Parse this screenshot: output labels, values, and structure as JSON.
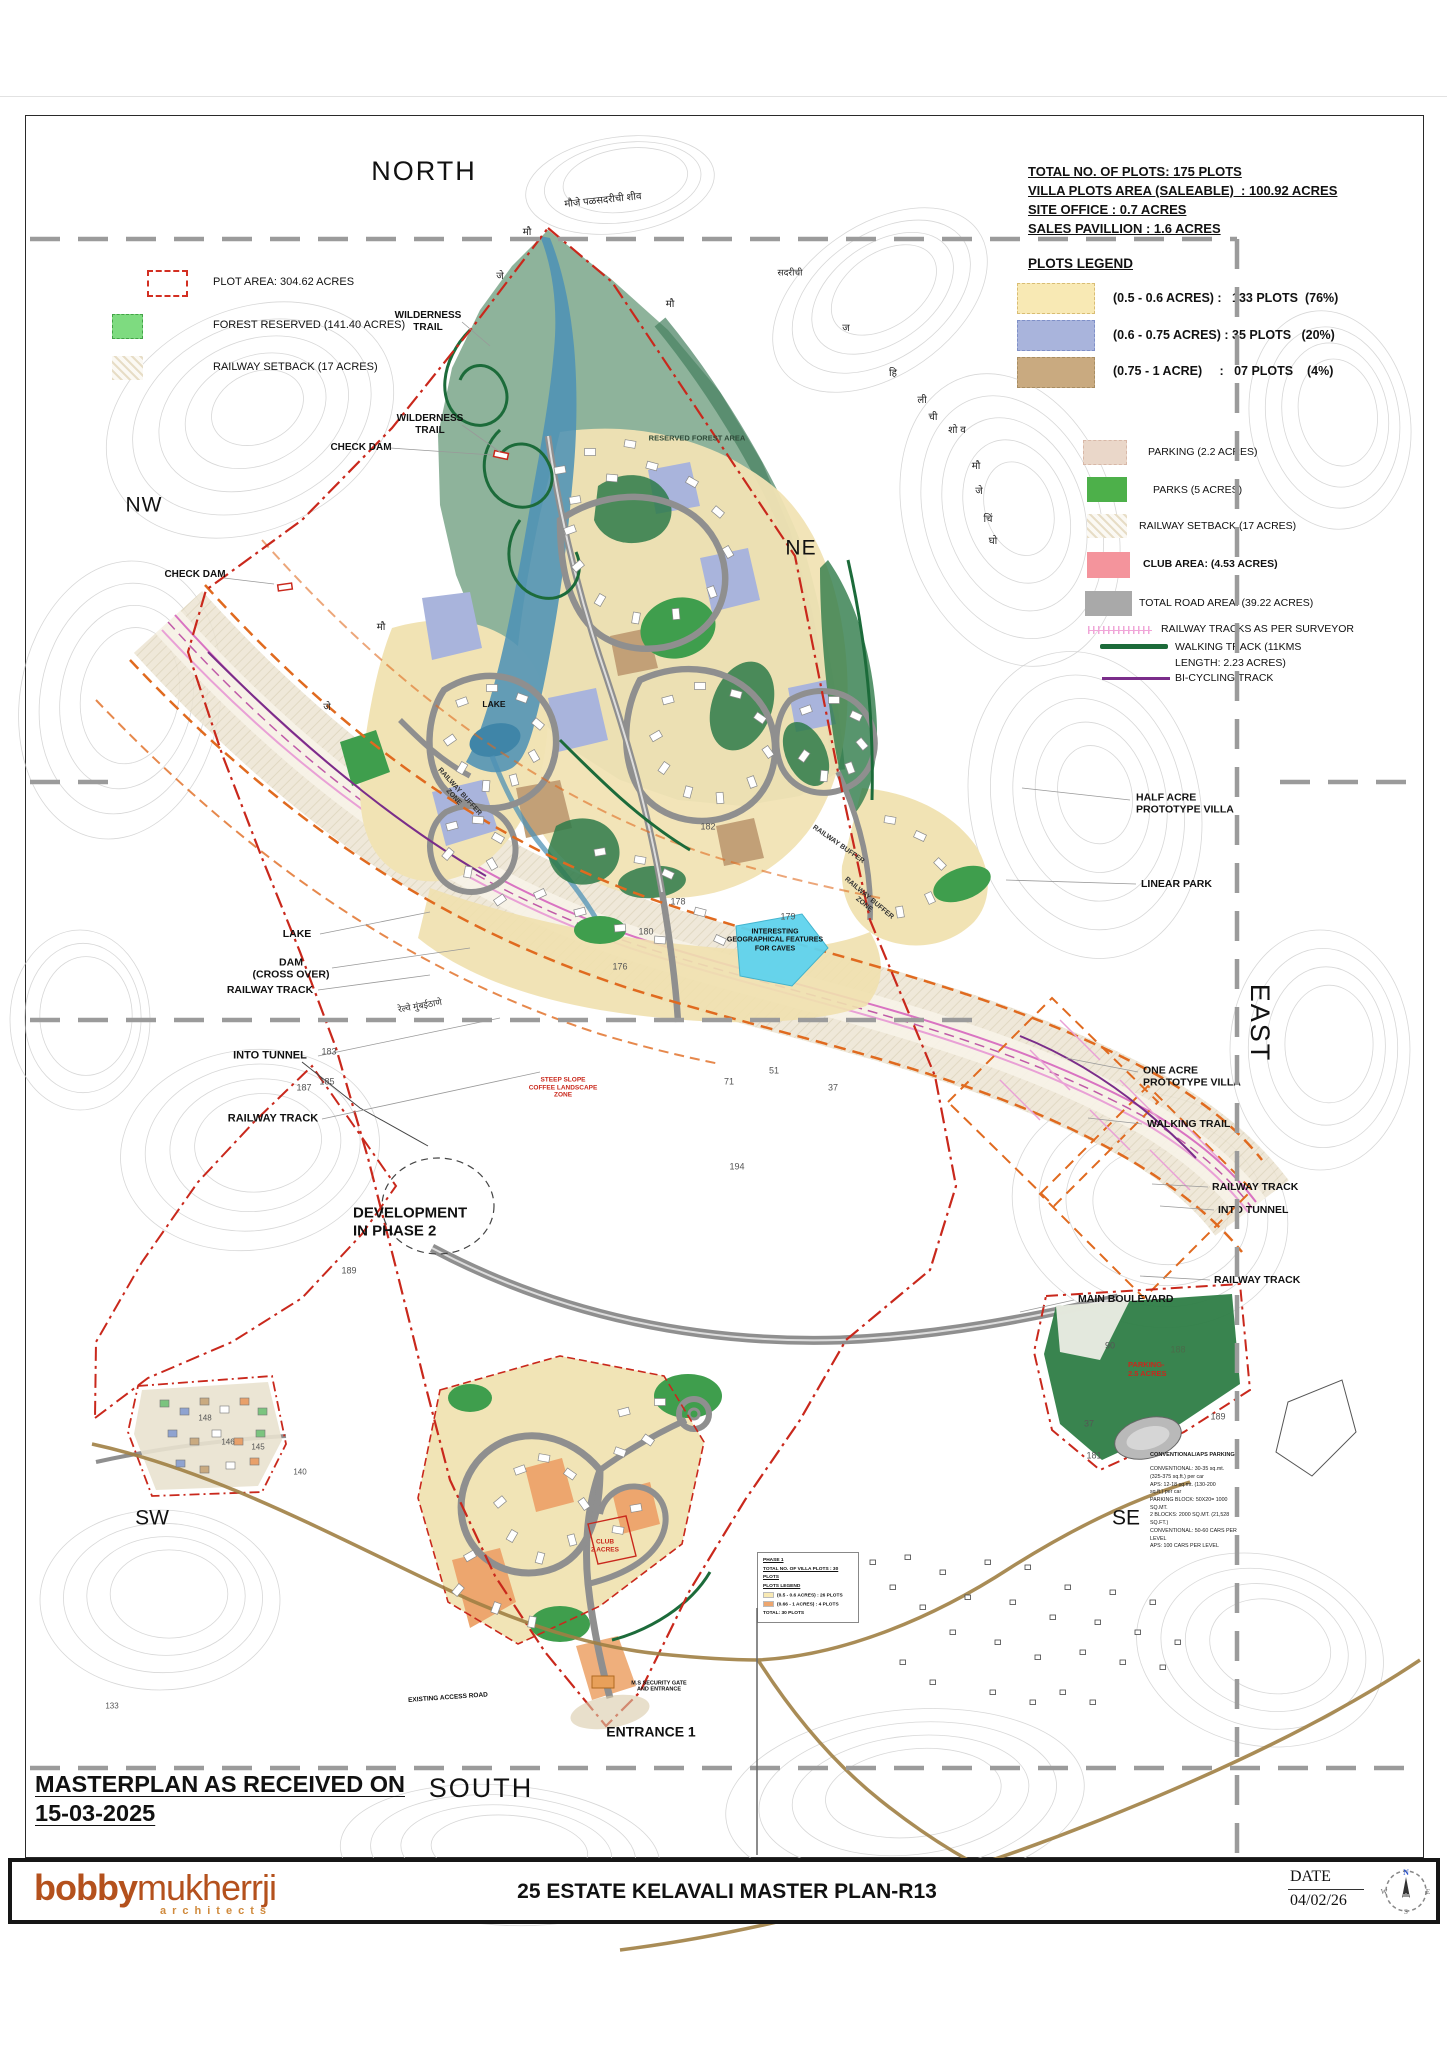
{
  "header_info": {
    "lines": [
      "TOTAL NO. OF PLOTS: 175 PLOTS",
      "VILLA PLOTS AREA (SALEABLE)  : 100.92 ACRES",
      "SITE OFFICE : 0.7 ACRES",
      "SALES PAVILLION : 1.6 ACRES"
    ]
  },
  "site_legend": {
    "plot_area": "PLOT AREA: 304.62 ACRES",
    "forest": "FOREST RESERVED (141.40 ACRES)",
    "railway": "RAILWAY SETBACK (17 ACRES)"
  },
  "plots_legend": {
    "title": "PLOTS LEGEND",
    "rows": [
      {
        "swatch": "#f8e9b4",
        "label": "(0.5 - 0.6 ACRES) :   133 PLOTS  (76%)"
      },
      {
        "swatch": "#a9b4dc",
        "label": "(0.6 - 0.75 ACRES) : 35 PLOTS   (20%)"
      },
      {
        "swatch": "#c9aa80",
        "label": "(0.75 - 1 ACRE)     :   07 PLOTS    (4%)"
      }
    ]
  },
  "features_legend": {
    "parking": "PARKING (2.2 ACRES)",
    "parks": "PARKS (5 ACRES)",
    "railway_setback": "RAILWAY SETBACK (17 ACRES)",
    "club": "CLUB AREA: (4.53 ACRES)",
    "road": "TOTAL ROAD AREA:    (39.22 ACRES)",
    "railway_tracks": "RAILWAY TRACKS AS PER SURVEYOR",
    "walking": "WALKING TRACK  (11KMS\nLENGTH: 2.23 ACRES)",
    "bicycling": "BI-CYCLING TRACK"
  },
  "received_note": {
    "line1": "MASTERPLAN AS RECEIVED ON",
    "line2": "15-03-2025"
  },
  "phase1_box": {
    "title": "PHASE 1",
    "subtitle": "TOTAL NO. OF VILLA PLOTS : 30 PLOTS",
    "legend_title": "PLOTS LEGEND",
    "row1": "(0.5 - 0.6 ACRES)  :  26 PLOTS",
    "row2": "(0.66 - 1 ACRES)  :  4 PLOTS",
    "total": "TOTAL: 30 PLOTS",
    "row1_color": "#f8e9b4",
    "row2_color": "#eda66e"
  },
  "parking_note": {
    "title": "CONVENTIONAL/APS PARKING",
    "body": "CONVENTIONAL: 30-35 sq.mt.\n(325-375 sq.ft.) per car\nAPS: 12-18 sq.mt. (130-200\nsq.ft.) per car\nPARKING BLOCK: 50X20= 1000\nSQ.MT.\n2 BLOCKS: 2000 SQ.MT. (21,528\nSQ.FT.)\nCONVENTIONAL: 50-60 CARS PER\nLEVEL\nAPS: 100 CARS PER LEVEL"
  },
  "title_block": {
    "logo_bold": "bobby",
    "logo_light": "mukherrji",
    "logo_sub": "architects",
    "title": "25 ESTATE KELAVALI MASTER PLAN-R13",
    "date_label": "DATE",
    "date_value": "04/02/26"
  },
  "colors": {
    "plot_small": "#f8e9b4",
    "plot_medium": "#a9b4dc",
    "plot_large": "#c9aa80",
    "parking": "#ead7c9",
    "parks": "#4db04a",
    "club": "#f4949c",
    "road": "#a9a9a9",
    "forest_reserved": "#7edb80",
    "boundary_red": "#c9281c",
    "railway_orange": "#e06a1f",
    "walking_green": "#1c6b3a",
    "bicycle_purple": "#7a2d8a",
    "railway_pink": "#e9a0d6",
    "lake_blue": "#4e92b5",
    "logo_orange": "#b4511d"
  },
  "map_labels": [
    {
      "t": "NORTH",
      "x": 424,
      "y": 172,
      "fs": 27,
      "fw": 400,
      "ls": 2,
      "name": "compass-north"
    },
    {
      "t": "NW",
      "x": 144,
      "y": 506,
      "fs": 21,
      "fw": 400,
      "ls": 1,
      "name": "compass-nw"
    },
    {
      "t": "NE",
      "x": 801,
      "y": 549,
      "fs": 21,
      "fw": 400,
      "ls": 1,
      "name": "compass-ne"
    },
    {
      "t": "EAST",
      "x": 1259,
      "y": 1023,
      "fs": 27,
      "fw": 400,
      "ls": 2,
      "rot": 90,
      "name": "compass-east"
    },
    {
      "t": "SOUTH",
      "x": 481,
      "y": 1789,
      "fs": 27,
      "fw": 400,
      "ls": 2,
      "name": "compass-south"
    },
    {
      "t": "SW",
      "x": 152,
      "y": 1519,
      "fs": 21,
      "fw": 400,
      "name": "compass-sw"
    },
    {
      "t": "SE",
      "x": 1126,
      "y": 1519,
      "fs": 21,
      "fw": 400,
      "name": "compass-se"
    },
    {
      "t": "WILDERNESS\nTRAIL",
      "x": 428,
      "y": 322,
      "fs": 10
    },
    {
      "t": "WILDERNESS\nTRAIL",
      "x": 430,
      "y": 425,
      "fs": 10
    },
    {
      "t": "CHECK DAM",
      "x": 361,
      "y": 448,
      "fs": 10
    },
    {
      "t": "CHECK DAM",
      "x": 195,
      "y": 575,
      "fs": 10
    },
    {
      "t": "LAKE",
      "x": 297,
      "y": 934,
      "fs": 10.5
    },
    {
      "t": "DAM\n(CROSS OVER)",
      "x": 291,
      "y": 969,
      "fs": 10.5
    },
    {
      "t": "RAILWAY TRACK",
      "x": 270,
      "y": 990,
      "fs": 10.5
    },
    {
      "t": "INTO TUNNEL",
      "x": 270,
      "y": 1056,
      "fs": 11
    },
    {
      "t": "RAILWAY TRACK",
      "x": 273,
      "y": 1119,
      "fs": 11
    },
    {
      "t": "DEVELOPMENT\nIN PHASE 2",
      "x": 353,
      "y": 1222,
      "fs": 15,
      "align": "left"
    },
    {
      "t": "HALF ACRE\nPROTOTYPE VILLA",
      "x": 1136,
      "y": 804,
      "fs": 10.5,
      "align": "left"
    },
    {
      "t": "LINEAR PARK",
      "x": 1141,
      "y": 884,
      "fs": 10.5,
      "align": "left"
    },
    {
      "t": "ONE ACRE\nPROTOTYPE VILLA",
      "x": 1143,
      "y": 1077,
      "fs": 10.5,
      "align": "left"
    },
    {
      "t": "WALKING TRAIL",
      "x": 1147,
      "y": 1124,
      "fs": 10.5,
      "align": "left"
    },
    {
      "t": "RAILWAY TRACK",
      "x": 1212,
      "y": 1187,
      "fs": 10.5,
      "align": "left"
    },
    {
      "t": "INTO TUNNEL",
      "x": 1218,
      "y": 1210,
      "fs": 10.5,
      "align": "left"
    },
    {
      "t": "RAILWAY TRACK",
      "x": 1214,
      "y": 1280,
      "fs": 10.5,
      "align": "left"
    },
    {
      "t": "MAIN BOULEVARD",
      "x": 1078,
      "y": 1299,
      "fs": 10.5,
      "align": "left"
    },
    {
      "t": "RESERVED FOREST AREA",
      "x": 697,
      "y": 439,
      "fs": 7.5,
      "fw": 600,
      "color": "#2e4a38"
    },
    {
      "t": "LAKE",
      "x": 494,
      "y": 704,
      "fs": 8.5
    },
    {
      "t": "INTERESTING\nGEOGRAPHICAL FEATURES\nFOR CAVES",
      "x": 775,
      "y": 941,
      "fs": 7
    },
    {
      "t": "ENTRANCE 1",
      "x": 651,
      "y": 1732,
      "fs": 14
    },
    {
      "t": "EXISTING ACCESS ROAD",
      "x": 448,
      "y": 1698,
      "fs": 6.5,
      "rot": -4
    },
    {
      "t": "M.S SECURITY GATE\nAND ENTRANCE",
      "x": 659,
      "y": 1687,
      "fs": 5.5
    },
    {
      "t": "RAILWAY BUFFER\nZONE",
      "x": 456,
      "y": 795,
      "fs": 7,
      "rot": 48,
      "color": "#333"
    },
    {
      "t": "RAILWAY BUFFER",
      "x": 838,
      "y": 845,
      "fs": 7,
      "rot": 35,
      "color": "#333"
    },
    {
      "t": "RAILWAY BUFFER\nZONE",
      "x": 866,
      "y": 902,
      "fs": 7,
      "rot": 40,
      "color": "#333"
    },
    {
      "t": "CLUB\n2 ACRES",
      "x": 605,
      "y": 1546,
      "fs": 6.5,
      "color": "#c9281c"
    },
    {
      "t": "PARKING-\n2.5 ACRES",
      "x": 1128,
      "y": 1370,
      "fs": 7.5,
      "color": "#c9281c",
      "align": "left"
    },
    {
      "t": "STEEP SLOPE\nCOFFEE LANDSCAPE\nZONE",
      "x": 563,
      "y": 1088,
      "fs": 6.5,
      "color": "#c9281c"
    },
    {
      "t": "मौजे पळसदरीची शीव",
      "x": 603,
      "y": 201,
      "fs": 10,
      "fw": 400,
      "rot": -6,
      "color": "#222"
    },
    {
      "t": "सदरीची",
      "x": 790,
      "y": 273,
      "fs": 9,
      "fw": 400,
      "color": "#222"
    },
    {
      "t": "मौ",
      "x": 527,
      "y": 233,
      "fs": 10,
      "fw": 400,
      "color": "#222"
    },
    {
      "t": "जे",
      "x": 500,
      "y": 277,
      "fs": 10,
      "fw": 400,
      "color": "#222"
    },
    {
      "t": "मौ",
      "x": 670,
      "y": 305,
      "fs": 10,
      "fw": 400,
      "color": "#222"
    },
    {
      "t": "ज",
      "x": 846,
      "y": 329,
      "fs": 10,
      "fw": 400,
      "color": "#222"
    },
    {
      "t": "हि",
      "x": 893,
      "y": 374,
      "fs": 10,
      "fw": 400,
      "color": "#222"
    },
    {
      "t": "ली",
      "x": 922,
      "y": 401,
      "fs": 10,
      "fw": 400,
      "color": "#222"
    },
    {
      "t": "ची",
      "x": 933,
      "y": 418,
      "fs": 10,
      "fw": 400,
      "color": "#222"
    },
    {
      "t": "शो व",
      "x": 957,
      "y": 431,
      "fs": 10,
      "fw": 400,
      "color": "#222"
    },
    {
      "t": "मौ",
      "x": 976,
      "y": 467,
      "fs": 10,
      "fw": 400,
      "color": "#222"
    },
    {
      "t": "जे",
      "x": 979,
      "y": 492,
      "fs": 10,
      "fw": 400,
      "color": "#222"
    },
    {
      "t": "चिं",
      "x": 988,
      "y": 520,
      "fs": 10,
      "fw": 400,
      "color": "#222"
    },
    {
      "t": "घो",
      "x": 993,
      "y": 542,
      "fs": 10,
      "fw": 400,
      "color": "#222"
    },
    {
      "t": "मौ",
      "x": 381,
      "y": 628,
      "fs": 10,
      "fw": 400,
      "color": "#222"
    },
    {
      "t": "जे",
      "x": 327,
      "y": 708,
      "fs": 10,
      "fw": 400,
      "color": "#222"
    },
    {
      "t": "रेल्वे मुंबईठाणे",
      "x": 420,
      "y": 1006,
      "fs": 9,
      "fw": 400,
      "rot": -10,
      "color": "#333"
    },
    {
      "t": "182",
      "x": 708,
      "y": 827,
      "fs": 9,
      "fw": 400,
      "color": "#555"
    },
    {
      "t": "178",
      "x": 678,
      "y": 902,
      "fs": 9,
      "fw": 400,
      "color": "#555"
    },
    {
      "t": "179",
      "x": 788,
      "y": 917,
      "fs": 9,
      "fw": 400,
      "color": "#555"
    },
    {
      "t": "180",
      "x": 646,
      "y": 932,
      "fs": 9,
      "fw": 400,
      "color": "#555"
    },
    {
      "t": "176",
      "x": 620,
      "y": 967,
      "fs": 9,
      "fw": 400,
      "color": "#555"
    },
    {
      "t": "183",
      "x": 329,
      "y": 1052,
      "fs": 9,
      "fw": 400,
      "color": "#555"
    },
    {
      "t": "185",
      "x": 327,
      "y": 1082,
      "fs": 9,
      "fw": 400,
      "color": "#555"
    },
    {
      "t": "187",
      "x": 304,
      "y": 1088,
      "fs": 9,
      "fw": 400,
      "color": "#555"
    },
    {
      "t": "189",
      "x": 349,
      "y": 1271,
      "fs": 9,
      "fw": 400,
      "color": "#555"
    },
    {
      "t": "51",
      "x": 774,
      "y": 1071,
      "fs": 9,
      "fw": 400,
      "color": "#555"
    },
    {
      "t": "71",
      "x": 729,
      "y": 1082,
      "fs": 9,
      "fw": 400,
      "color": "#555"
    },
    {
      "t": "37",
      "x": 833,
      "y": 1088,
      "fs": 9,
      "fw": 400,
      "color": "#555"
    },
    {
      "t": "194",
      "x": 737,
      "y": 1167,
      "fs": 9,
      "fw": 400,
      "color": "#555"
    },
    {
      "t": "90",
      "x": 1110,
      "y": 1346,
      "fs": 9,
      "fw": 400,
      "color": "#555"
    },
    {
      "t": "188",
      "x": 1178,
      "y": 1350,
      "fs": 9,
      "fw": 400,
      "color": "#4a6b4a"
    },
    {
      "t": "189",
      "x": 1218,
      "y": 1417,
      "fs": 9,
      "fw": 400,
      "color": "#555"
    },
    {
      "t": "37",
      "x": 1089,
      "y": 1424,
      "fs": 9,
      "fw": 400,
      "color": "#555"
    },
    {
      "t": "181",
      "x": 1094,
      "y": 1456,
      "fs": 9,
      "fw": 400,
      "color": "#555"
    },
    {
      "t": "148",
      "x": 205,
      "y": 1418,
      "fs": 8,
      "fw": 400,
      "color": "#555"
    },
    {
      "t": "146",
      "x": 228,
      "y": 1442,
      "fs": 8,
      "fw": 400,
      "color": "#555"
    },
    {
      "t": "145",
      "x": 258,
      "y": 1447,
      "fs": 8,
      "fw": 400,
      "color": "#555"
    },
    {
      "t": "140",
      "x": 300,
      "y": 1472,
      "fs": 8,
      "fw": 400,
      "color": "#555"
    },
    {
      "t": "133",
      "x": 112,
      "y": 1706,
      "fs": 8,
      "fw": 400,
      "color": "#555"
    }
  ]
}
